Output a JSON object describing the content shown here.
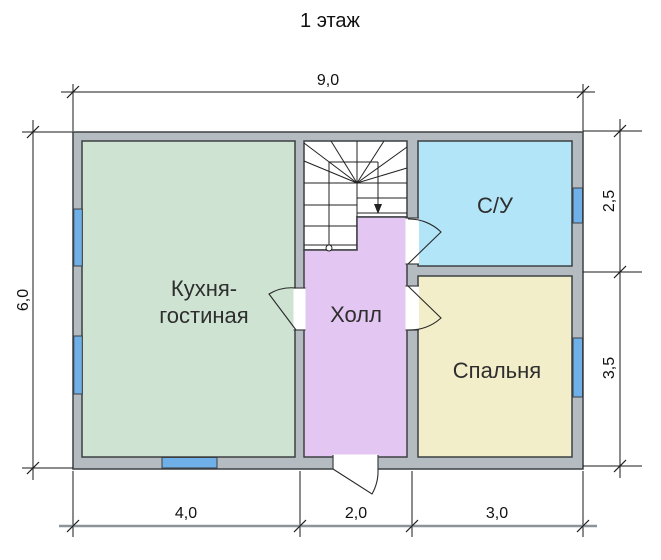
{
  "title": "1 этаж",
  "colors": {
    "wall": "#b4bcc1",
    "kitchen": "#cfe3d3",
    "hall": "#e3c7f2",
    "bathroom": "#b3e5f8",
    "bedroom": "#f3eeca",
    "window": "#6fb0e8",
    "outline": "#3d4043"
  },
  "rooms": {
    "kitchen": {
      "label_line1": "Кухня-",
      "label_line2": "гостиная"
    },
    "hall": {
      "label": "Холл"
    },
    "bathroom": {
      "label": "С/У"
    },
    "bedroom": {
      "label": "Спальня"
    }
  },
  "dimensions": {
    "top_width": "9,0",
    "left_height": "6,0",
    "right_top": "2,5",
    "right_bottom": "3,5",
    "bottom_left": "4,0",
    "bottom_middle": "2,0",
    "bottom_right": "3,0"
  }
}
